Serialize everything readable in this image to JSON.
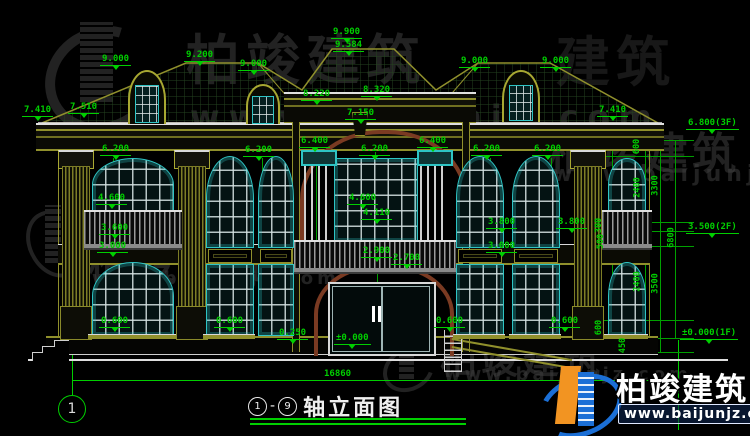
{
  "colors": {
    "background": "#000000",
    "dimension_green": "#00cf00",
    "line_olive": "#90902c",
    "window_teal": "#2ec4c4",
    "frame_white": "#e0e0e0",
    "arch_brown": "#7a3a22",
    "logo_blue": "#1b6fd6",
    "logo_orange": "#f29422",
    "watermark_gray": "#3e3e3e"
  },
  "title_block": {
    "axis_start": "1",
    "dash": "-",
    "axis_end": "9",
    "name": "轴立面图"
  },
  "axis_bubbles": {
    "left": "1"
  },
  "overall_dim": "16860",
  "brand": {
    "name": "柏竣建筑",
    "url": "www.baijunjz.com"
  },
  "dim_labels": [
    {
      "t": "9.000",
      "x": 100,
      "y": 54,
      "s": "tri"
    },
    {
      "t": "9.200",
      "x": 184,
      "y": 50,
      "s": "tri"
    },
    {
      "t": "9.000",
      "x": 238,
      "y": 59,
      "s": "tri"
    },
    {
      "t": "9.900",
      "x": 331,
      "y": 27,
      "s": "tri"
    },
    {
      "t": "9.584",
      "x": 333,
      "y": 40,
      "s": "tri"
    },
    {
      "t": "8.220",
      "x": 301,
      "y": 89,
      "s": "tri"
    },
    {
      "t": "8.320",
      "x": 361,
      "y": 85,
      "s": "tri"
    },
    {
      "t": "9.000",
      "x": 459,
      "y": 56,
      "s": "tri"
    },
    {
      "t": "9.000",
      "x": 540,
      "y": 56,
      "s": "tri"
    },
    {
      "t": "7.410",
      "x": 22,
      "y": 105,
      "s": "tri"
    },
    {
      "t": "7.510",
      "x": 68,
      "y": 102,
      "s": "tri"
    },
    {
      "t": "7.150",
      "x": 345,
      "y": 108,
      "s": "tri"
    },
    {
      "t": "7.410",
      "x": 597,
      "y": 105,
      "s": "tri"
    },
    {
      "t": "6.800(3F)",
      "x": 686,
      "y": 118,
      "s": "tri"
    },
    {
      "t": "6.200",
      "x": 100,
      "y": 144,
      "s": "tri"
    },
    {
      "t": "6.200",
      "x": 243,
      "y": 145,
      "s": "tri"
    },
    {
      "t": "6.400",
      "x": 299,
      "y": 136,
      "s": "tri"
    },
    {
      "t": "6.200",
      "x": 359,
      "y": 144,
      "s": "tri"
    },
    {
      "t": "6.400",
      "x": 417,
      "y": 136,
      "s": "tri"
    },
    {
      "t": "6.200",
      "x": 471,
      "y": 144,
      "s": "tri"
    },
    {
      "t": "6.200",
      "x": 532,
      "y": 144,
      "s": "tri"
    },
    {
      "t": "4.600",
      "x": 96,
      "y": 193,
      "s": "tri"
    },
    {
      "t": "4.600",
      "x": 347,
      "y": 193,
      "s": "tri"
    },
    {
      "t": "4.110",
      "x": 361,
      "y": 208,
      "s": "tri"
    },
    {
      "t": "3.600",
      "x": 99,
      "y": 223,
      "s": "tri"
    },
    {
      "t": "3.000",
      "x": 97,
      "y": 241,
      "s": "tri"
    },
    {
      "t": "3.800",
      "x": 486,
      "y": 217,
      "s": "tri"
    },
    {
      "t": "3.800",
      "x": 556,
      "y": 217,
      "s": "tri"
    },
    {
      "t": "3.000",
      "x": 486,
      "y": 241,
      "s": "tri"
    },
    {
      "t": "2.900",
      "x": 361,
      "y": 246,
      "s": "tri"
    },
    {
      "t": "2.700",
      "x": 391,
      "y": 253,
      "s": "tri"
    },
    {
      "t": "3.500(2F)",
      "x": 686,
      "y": 222,
      "s": "tri"
    },
    {
      "t": "0.250",
      "x": 277,
      "y": 328,
      "s": "tri"
    },
    {
      "t": "0.600",
      "x": 99,
      "y": 316,
      "s": "tri"
    },
    {
      "t": "0.600",
      "x": 214,
      "y": 316,
      "s": "tri"
    },
    {
      "t": "0.600",
      "x": 434,
      "y": 316,
      "s": "tri"
    },
    {
      "t": "0.600",
      "x": 549,
      "y": 316,
      "s": "tri"
    },
    {
      "t": "±0.000",
      "x": 334,
      "y": 333,
      "s": "tri"
    },
    {
      "t": "±0.000(1F)",
      "x": 680,
      "y": 328,
      "s": "tri"
    },
    {
      "t": "16860",
      "x": 322,
      "y": 369,
      "s": "plain"
    },
    {
      "t": "600",
      "x": 628,
      "y": 141,
      "s": "rot"
    },
    {
      "t": "2400",
      "x": 626,
      "y": 182,
      "s": "rot"
    },
    {
      "t": "300",
      "x": 590,
      "y": 220,
      "s": "rot"
    },
    {
      "t": "500",
      "x": 592,
      "y": 236,
      "s": "rot"
    },
    {
      "t": "2400",
      "x": 626,
      "y": 276,
      "s": "rot"
    },
    {
      "t": "600",
      "x": 590,
      "y": 322,
      "s": "rot"
    },
    {
      "t": "450",
      "x": 614,
      "y": 340,
      "s": "rot"
    },
    {
      "t": "3300",
      "x": 644,
      "y": 180,
      "s": "rot"
    },
    {
      "t": "3500",
      "x": 644,
      "y": 278,
      "s": "rot"
    },
    {
      "t": "6800",
      "x": 660,
      "y": 232,
      "s": "rot"
    }
  ],
  "chain_extension_y": [
    140,
    156,
    222,
    231,
    246,
    320,
    338,
    352
  ],
  "watermarks": [
    {
      "type": "logo",
      "x": 44,
      "y": 12,
      "w": 112,
      "h": 122
    },
    {
      "type": "cjk",
      "t": "柏竣建筑",
      "x": 186,
      "y": 16,
      "size": 54,
      "ls": 6
    },
    {
      "type": "url",
      "t": "www.baijunjz.com",
      "x": 190,
      "y": 98,
      "size": 32,
      "ls": 9
    },
    {
      "type": "cjk",
      "t": "建筑",
      "x": 556,
      "y": 18,
      "size": 54,
      "ls": 6,
      "op": 0.4
    },
    {
      "type": "cjk",
      "t": "柏竣建筑",
      "x": 548,
      "y": 118,
      "size": 44,
      "ls": 4
    },
    {
      "type": "url",
      "t": "www.baijunjz.com",
      "x": 552,
      "y": 162,
      "size": 22,
      "ls": 5
    },
    {
      "type": "logo",
      "x": 28,
      "y": 198,
      "w": 54,
      "h": 88
    },
    {
      "type": "cjk",
      "t": "柏竣建筑",
      "x": 88,
      "y": 230,
      "size": 41,
      "ls": 4
    },
    {
      "type": "url",
      "t": "www.baijunjz.com",
      "x": 92,
      "y": 268,
      "size": 18,
      "ls": 4
    },
    {
      "type": "logo",
      "x": 382,
      "y": 342,
      "w": 52,
      "h": 50
    },
    {
      "type": "cjk",
      "t": "柏竣建筑",
      "x": 440,
      "y": 330,
      "size": 37,
      "ls": 4
    },
    {
      "type": "url",
      "t": "www.baijunjz.com",
      "x": 444,
      "y": 364,
      "size": 18,
      "ls": 4
    }
  ]
}
